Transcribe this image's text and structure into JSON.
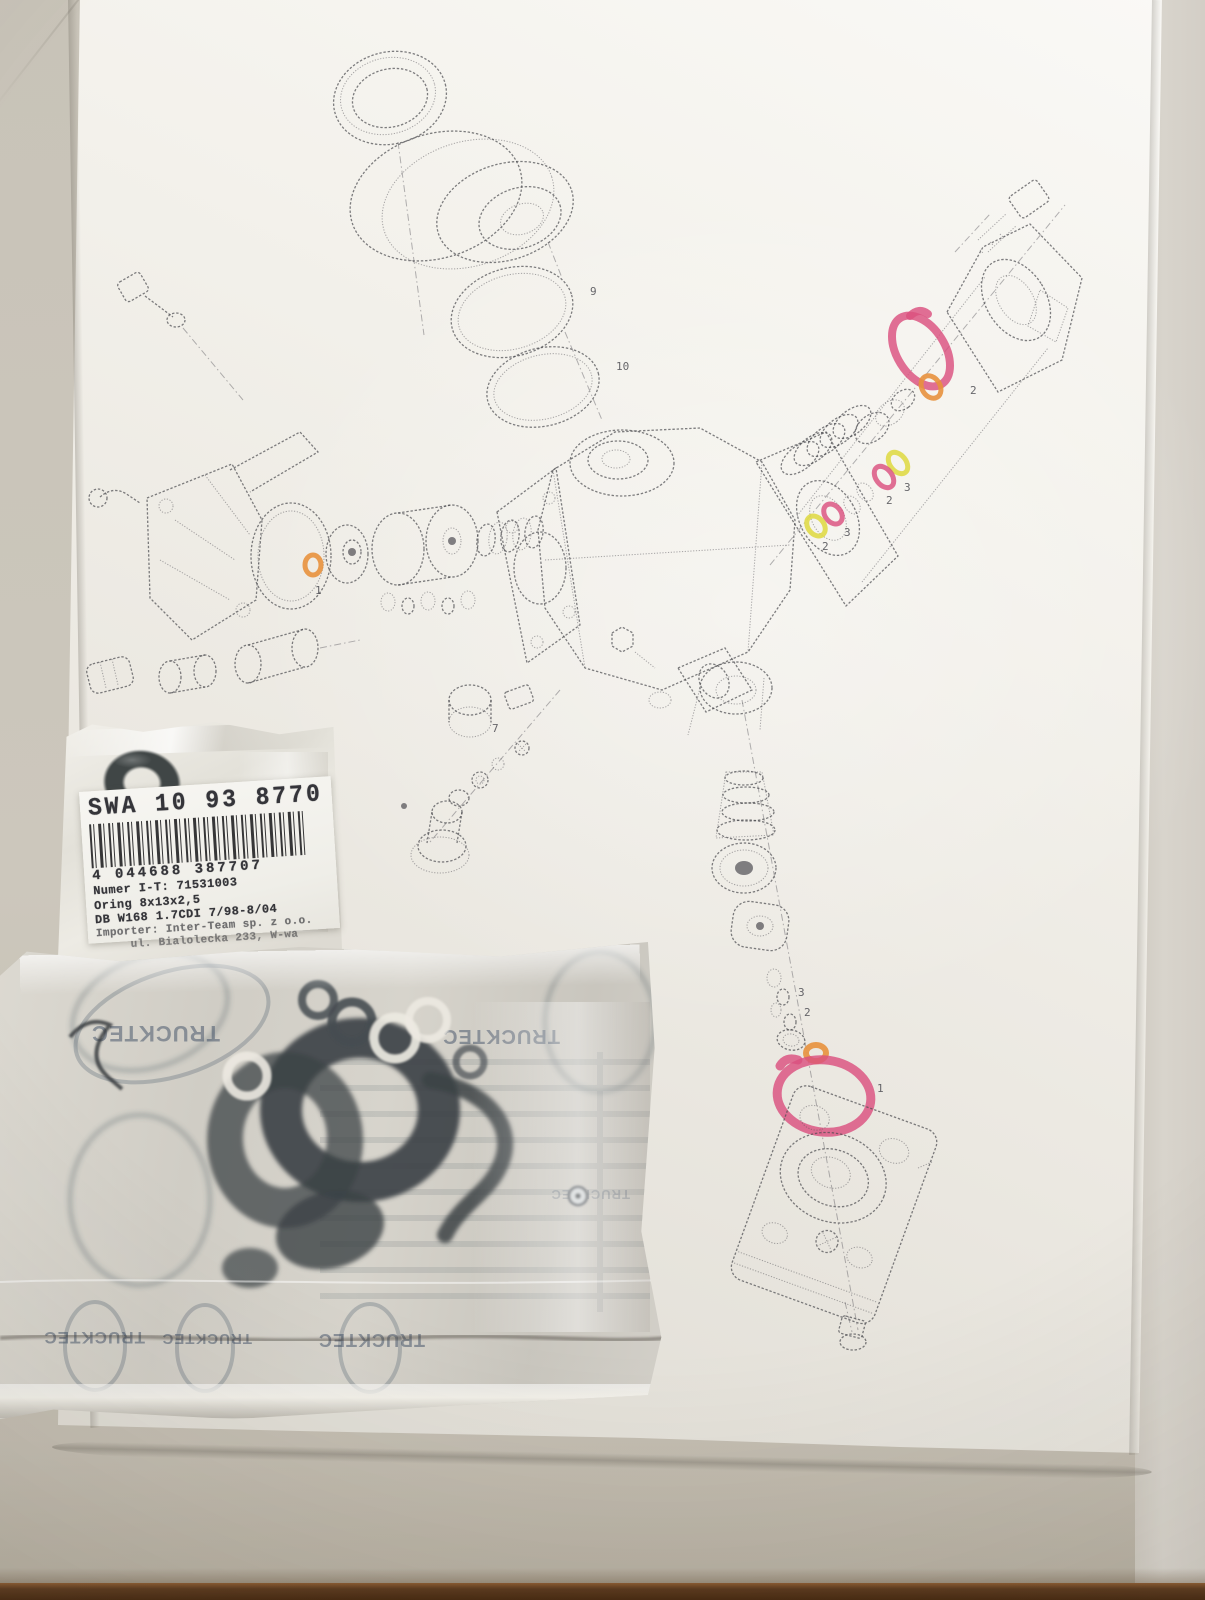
{
  "paper_diagram": {
    "type": "exploded-parts-drawing",
    "callouts": [
      "1",
      "9",
      "10",
      "2",
      "3",
      "2",
      "3",
      "2",
      "7",
      "1",
      "3",
      "2"
    ],
    "highlight_colors": {
      "pink": "#da517f",
      "orange": "#e8913d",
      "yellow": "#e0da48"
    }
  },
  "part_label": {
    "title": "SWA 10 93 8770",
    "barcode_number": "4 044688 387707",
    "info_lines": [
      "Numer I-T: 71531003",
      "Oring 8x13x2,5",
      "DB W168 1.7CDI 7/98-8/04",
      "Importer: Inter-Team sp. z o.o.",
      "ul. Bialolecka 233, W-wa"
    ]
  },
  "seal_kit_bag": {
    "watermark": "TRUCKTEC"
  }
}
